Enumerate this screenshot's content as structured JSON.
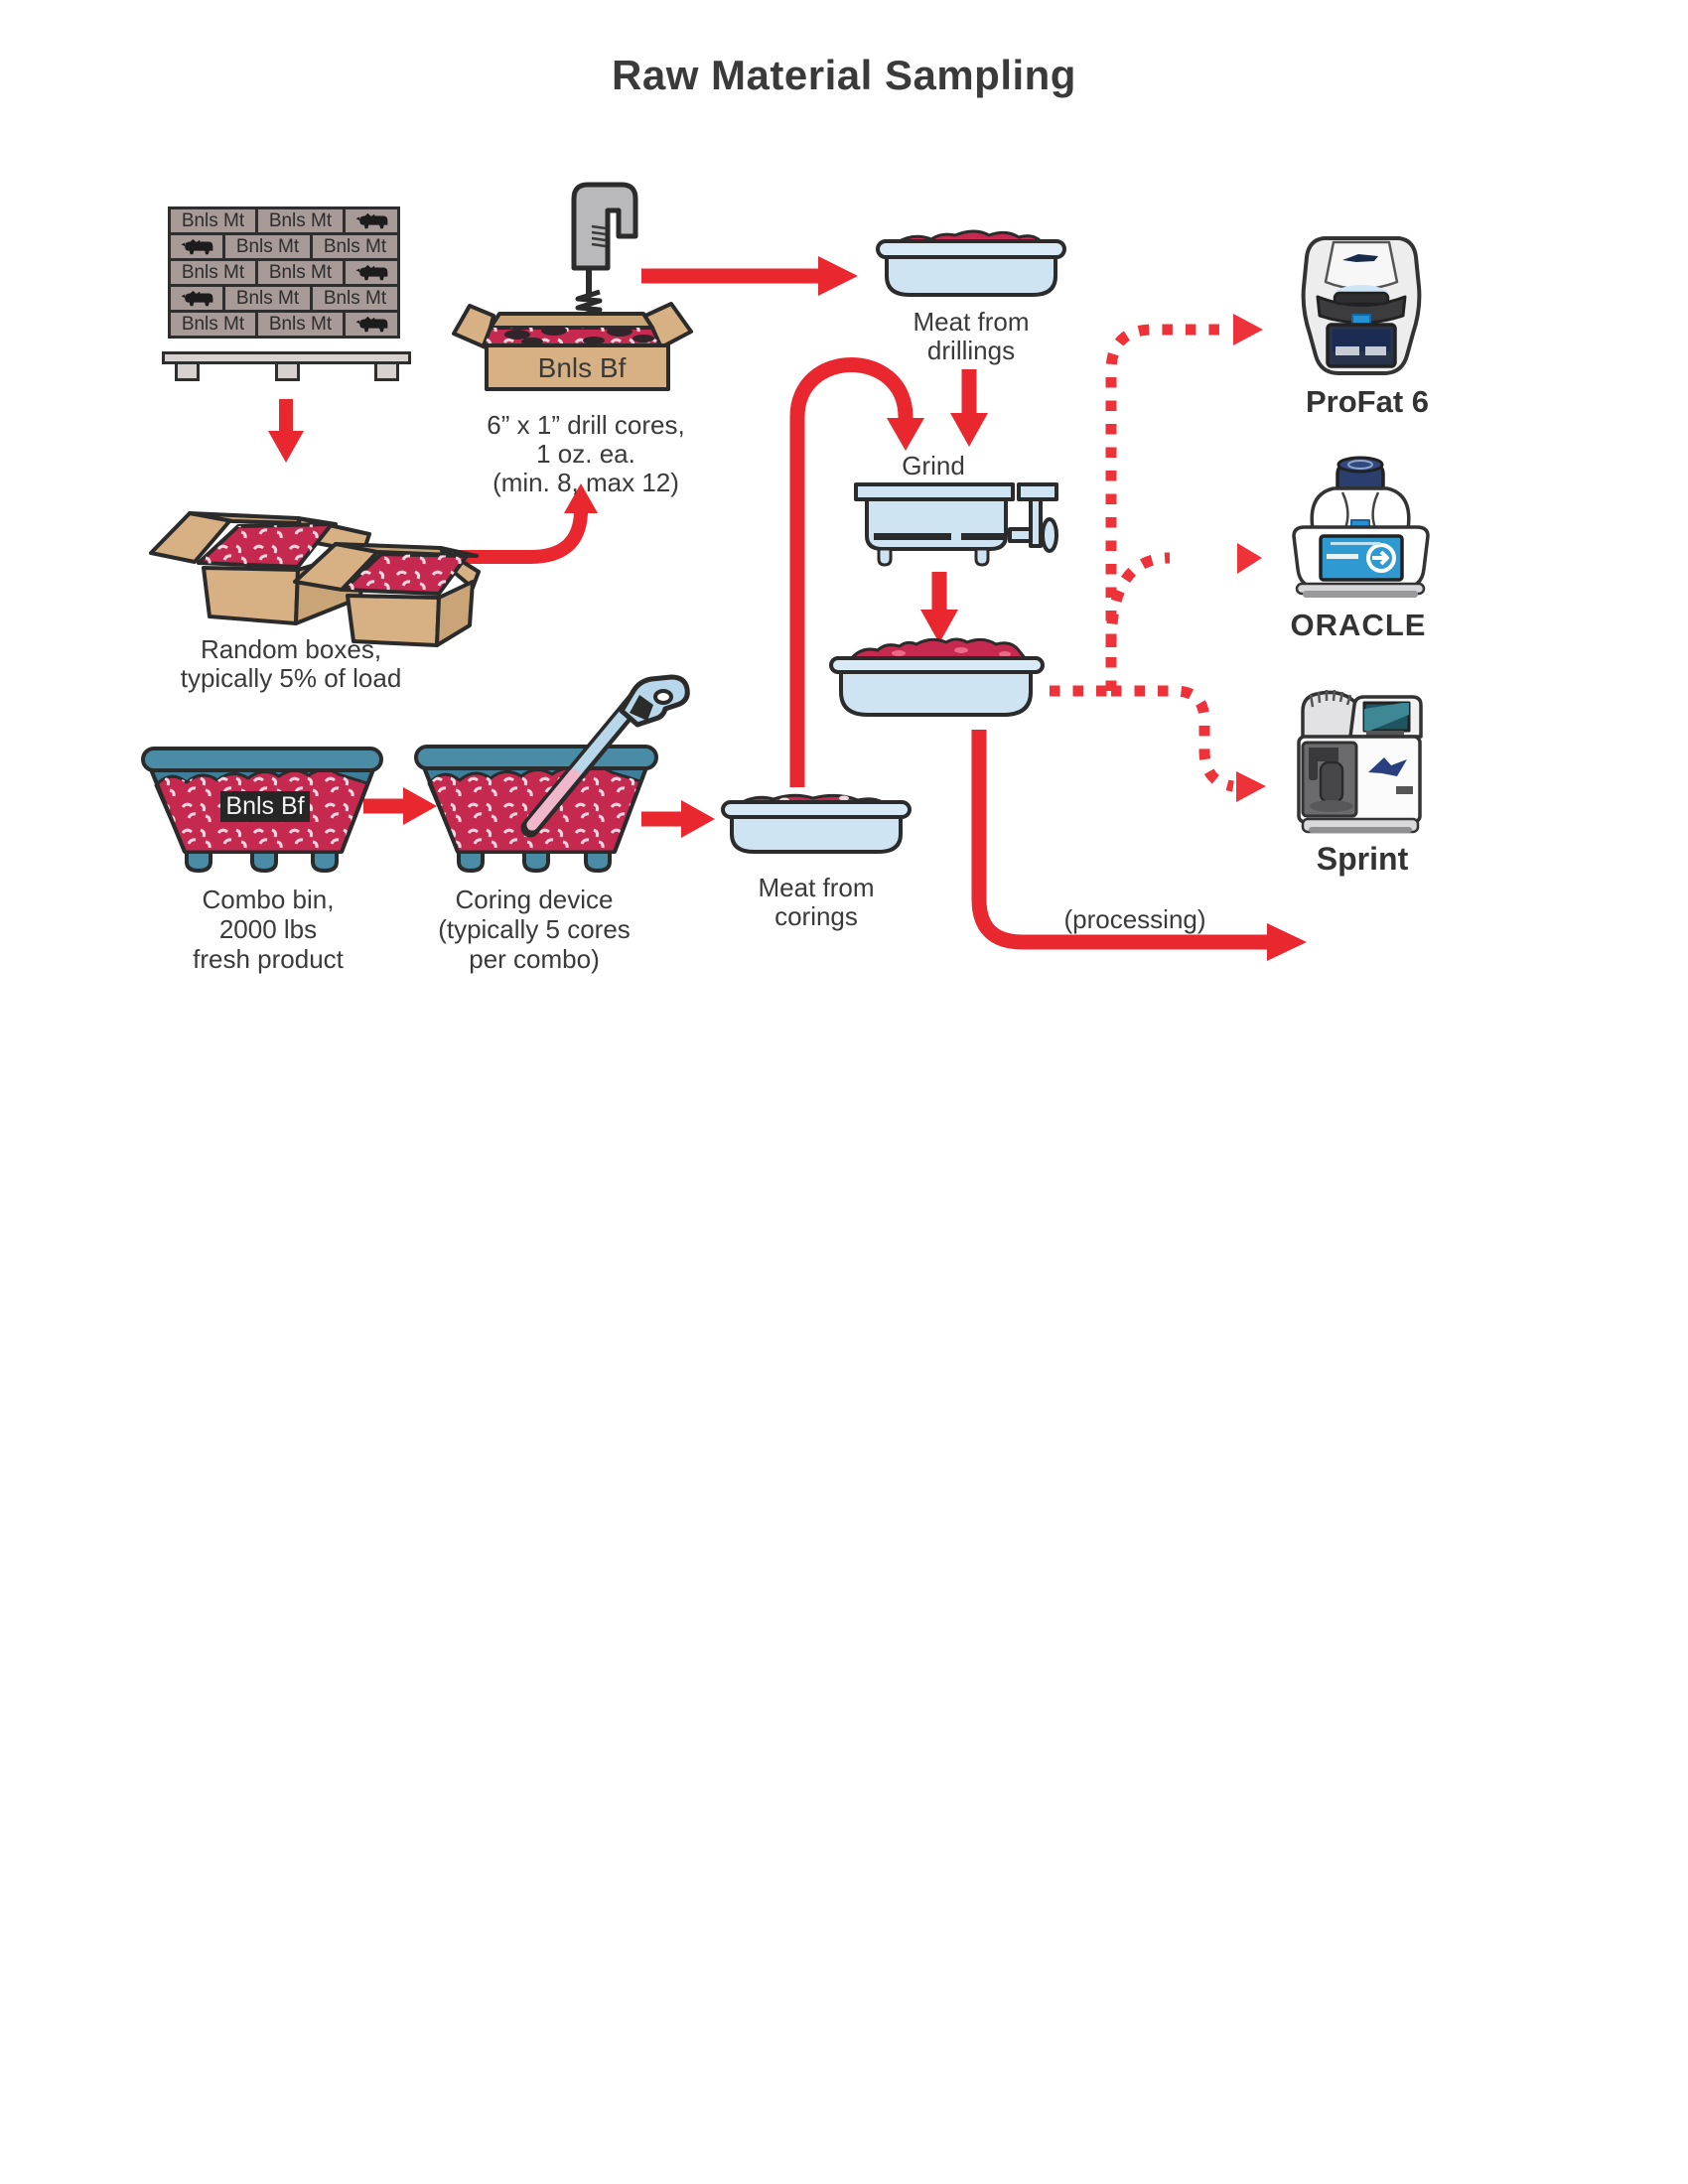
{
  "title": "Raw Material Sampling",
  "colors": {
    "arrow_red": "#e8272e",
    "dashed_red": "#ee3239",
    "meat_crimson": "#c5294f",
    "meat_fleck": "#f3d7e0",
    "bin_teal": "#4a8ba6",
    "cardboard_tan": "#d7b183",
    "tray_blue": "#cfe4f3",
    "pallet_box_taupe": "#a79a97",
    "outline_ink": "#2b2b2b",
    "screen_blue": "#2f9ad2",
    "panel_navy": "#28344a"
  },
  "pallet": {
    "box_label": "Bnls Mt",
    "rows": [
      [
        "label",
        "label",
        "icon"
      ],
      [
        "icon",
        "label",
        "label"
      ],
      [
        "label",
        "label",
        "icon"
      ],
      [
        "icon",
        "label",
        "label"
      ],
      [
        "label",
        "label",
        "icon"
      ]
    ],
    "icon_name": "cattle-icon"
  },
  "random_boxes": {
    "caption_line1": "Random boxes,",
    "caption_line2": "typically 5% of load"
  },
  "drill_station": {
    "box_label": "Bnls Bf",
    "caption_line1": "6” x 1” drill cores,",
    "caption_line2": "1 oz. ea.",
    "caption_line3": "(min. 8, max 12)"
  },
  "drillings_tray": {
    "caption_line1": "Meat from",
    "caption_line2": "drillings"
  },
  "grind": {
    "label": "Grind"
  },
  "combo_bin": {
    "plate_label": "Bnls Bf",
    "caption_line1": "Combo bin,",
    "caption_line2": "2000 lbs",
    "caption_line3": "fresh product"
  },
  "coring": {
    "caption_line1": "Coring device",
    "caption_line2": "(typically 5 cores",
    "caption_line3": "per combo)"
  },
  "corings_tray": {
    "caption_line1": "Meat from",
    "caption_line2": "corings"
  },
  "processing": {
    "label": "(processing)"
  },
  "instruments": {
    "profat": {
      "label": "ProFat 6"
    },
    "oracle": {
      "label": "ORACLE"
    },
    "sprint": {
      "label": "Sprint"
    }
  }
}
